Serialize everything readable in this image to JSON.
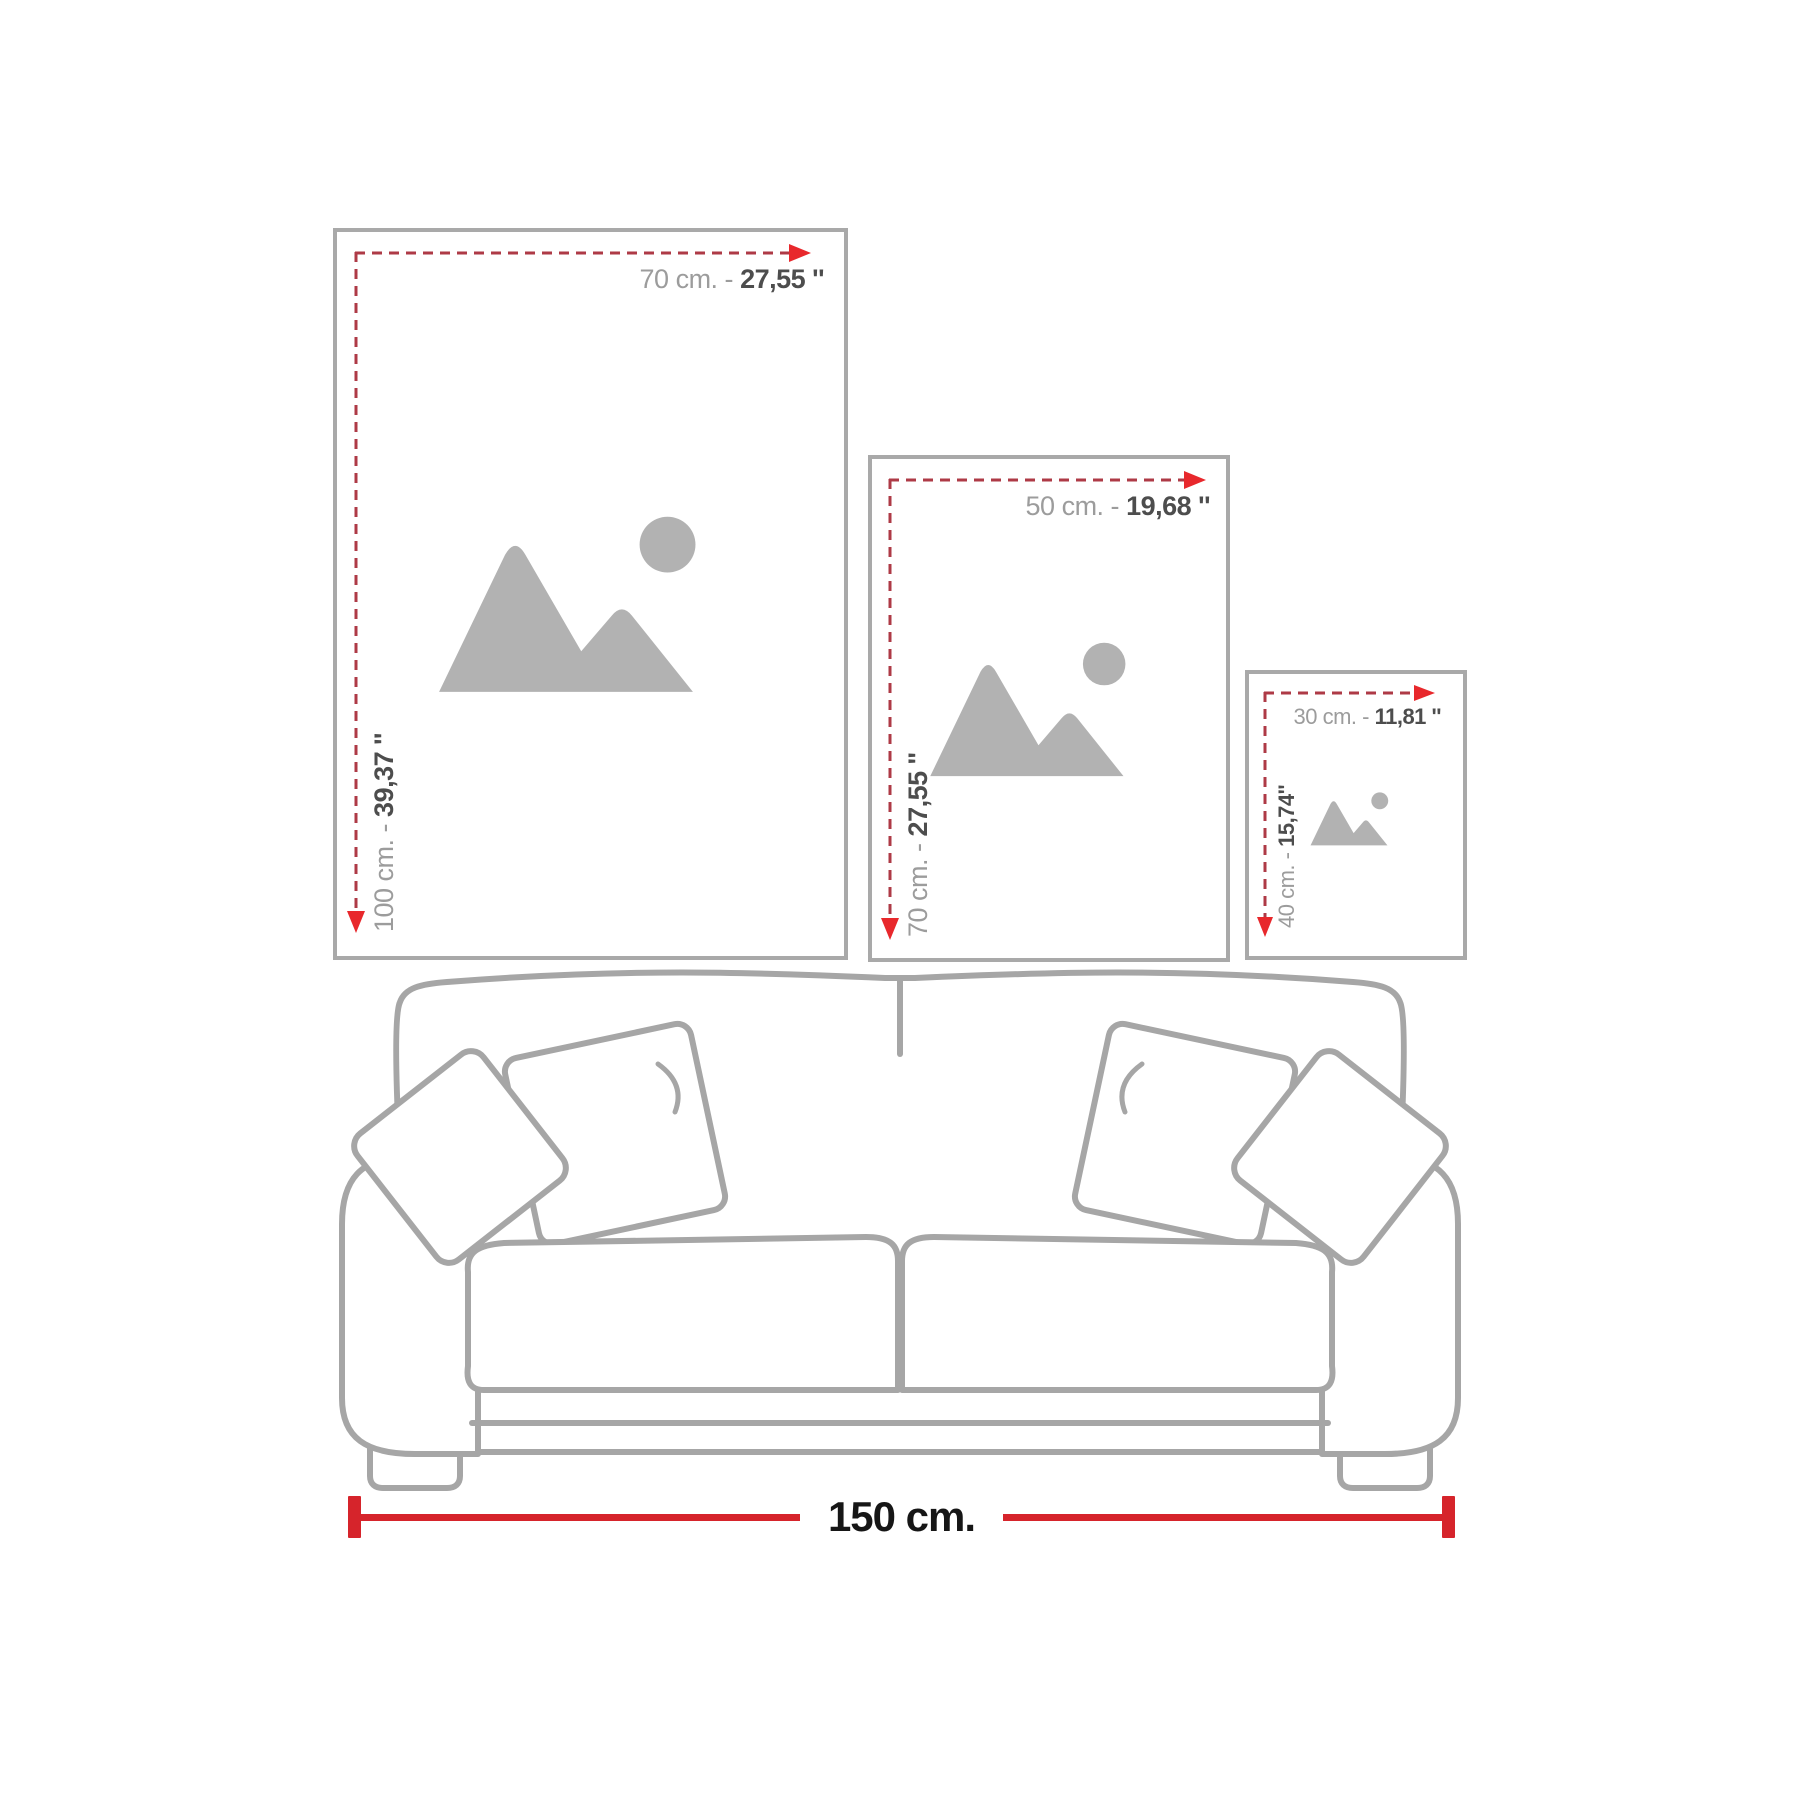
{
  "colors": {
    "frame_border": "#a9a9a9",
    "placeholder": "#b2b2b2",
    "dash": "#ae3a46",
    "arrow": "#e8282c",
    "measure": "#d6242b",
    "label_light": "#9c9c9c",
    "label_dark": "#4d4d4d",
    "sofa_line": "#a6a6a6",
    "measure_text": "#161616"
  },
  "frames": [
    {
      "id": "large",
      "width_cm": "70 cm. -",
      "width_in": "27,55 ''",
      "height_cm": "100 cm. -",
      "height_in": "39,37 ''",
      "icon": "image-placeholder-icon"
    },
    {
      "id": "medium",
      "width_cm": "50 cm. -",
      "width_in": "19,68 ''",
      "height_cm": "70 cm. -",
      "height_in": "27,55 ''",
      "icon": "image-placeholder-icon"
    },
    {
      "id": "small",
      "width_cm": "30 cm. -",
      "width_in": "11,81 ''",
      "height_cm": "40 cm. -",
      "height_in": "15,74''",
      "icon": "image-placeholder-icon"
    }
  ],
  "sofa": {
    "width_label": "150 cm."
  }
}
